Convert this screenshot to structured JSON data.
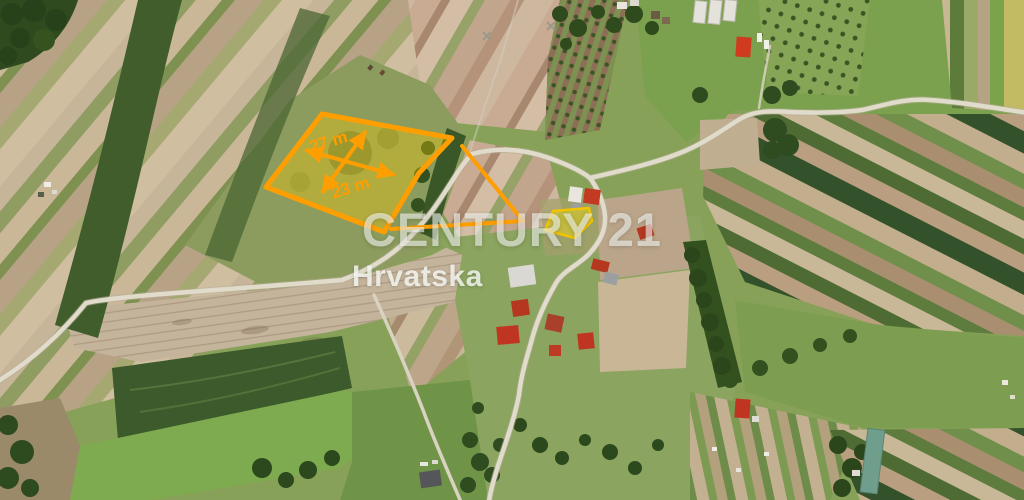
{
  "annotation": {
    "accent_color": "#FF9E00",
    "parcel_fill_color": "rgba(255,205,0,0.33)",
    "location_outline_color": "#F2C400",
    "location_fill_color": "rgba(255,228,0,0.38)",
    "dimensions": {
      "width": {
        "label": "27 m"
      },
      "depth": {
        "label": "23 m"
      }
    }
  },
  "watermark": {
    "brand": "CENTURY 21",
    "region": "Hrvatska",
    "color": "#FFFFFF"
  }
}
